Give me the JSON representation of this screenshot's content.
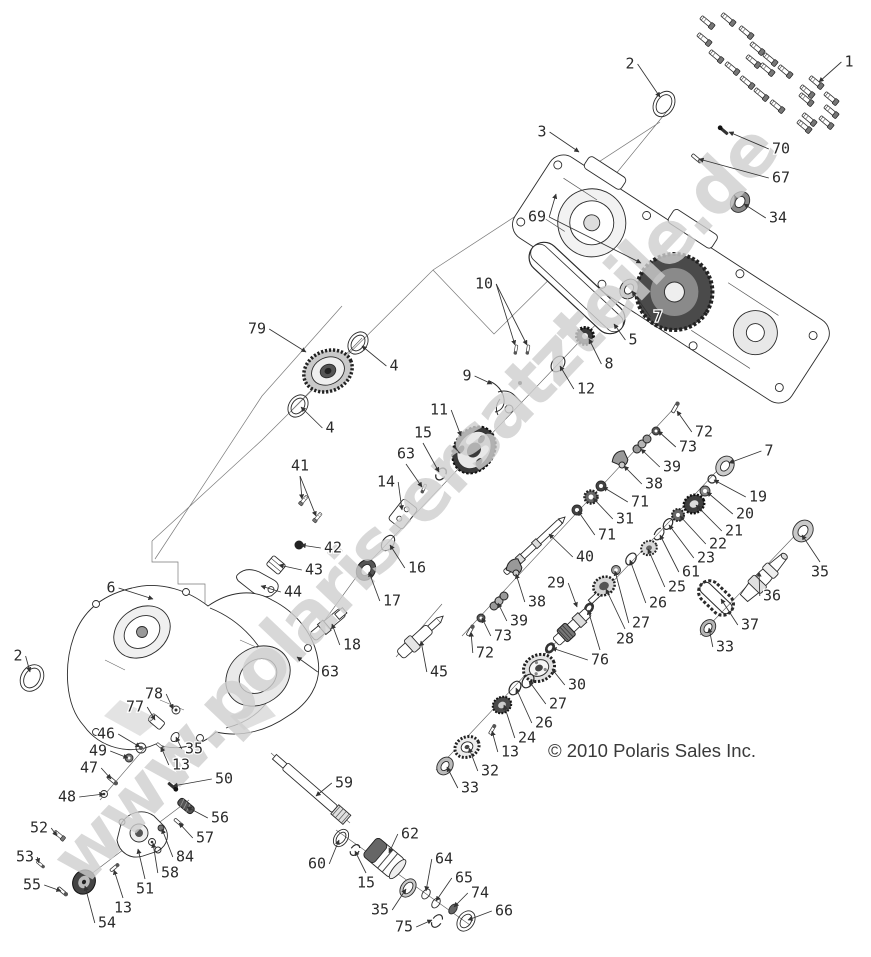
{
  "watermark": {
    "text": "www.polaris-ersatzteile.de"
  },
  "copyright": {
    "text": "© 2010 Polaris Sales Inc."
  },
  "callouts": [
    {
      "n": "1",
      "x": 849,
      "y": 62,
      "t": [
        [
          819,
          82
        ]
      ]
    },
    {
      "n": "2",
      "x": 630,
      "y": 64,
      "t": [
        [
          660,
          97
        ]
      ]
    },
    {
      "n": "3",
      "x": 542,
      "y": 132,
      "t": [
        [
          579,
          152
        ]
      ]
    },
    {
      "n": "70",
      "x": 781,
      "y": 149,
      "t": [
        [
          729,
          132
        ]
      ]
    },
    {
      "n": "67",
      "x": 781,
      "y": 178,
      "t": [
        [
          699,
          159
        ]
      ]
    },
    {
      "n": "34",
      "x": 778,
      "y": 218,
      "t": [
        [
          744,
          204
        ]
      ]
    },
    {
      "n": "69",
      "x": 537,
      "y": 217,
      "t": [
        [
          556,
          194
        ],
        [
          641,
          263
        ]
      ]
    },
    {
      "n": "10",
      "x": 484,
      "y": 284,
      "t": [
        [
          515,
          345
        ],
        [
          527,
          345
        ]
      ]
    },
    {
      "n": "7",
      "x": 658,
      "y": 317,
      "t": [
        [
          632,
          291
        ]
      ]
    },
    {
      "n": "5",
      "x": 633,
      "y": 340,
      "t": [
        [
          614,
          324
        ]
      ]
    },
    {
      "n": "8",
      "x": 609,
      "y": 364,
      "t": [
        [
          589,
          339
        ]
      ]
    },
    {
      "n": "12",
      "x": 586,
      "y": 389,
      "t": [
        [
          560,
          366
        ]
      ]
    },
    {
      "n": "9",
      "x": 467,
      "y": 376,
      "t": [
        [
          492,
          384
        ]
      ]
    },
    {
      "n": "79",
      "x": 257,
      "y": 329,
      "t": [
        [
          306,
          352
        ]
      ]
    },
    {
      "n": "4",
      "x": 394,
      "y": 366,
      "t": [
        [
          362,
          346
        ]
      ]
    },
    {
      "n": "4",
      "x": 330,
      "y": 428,
      "t": [
        [
          301,
          407
        ]
      ]
    },
    {
      "n": "11",
      "x": 439,
      "y": 410,
      "t": [
        [
          461,
          436
        ]
      ]
    },
    {
      "n": "15",
      "x": 423,
      "y": 433,
      "t": [
        [
          439,
          472
        ]
      ]
    },
    {
      "n": "63",
      "x": 406,
      "y": 454,
      "t": [
        [
          422,
          487
        ]
      ]
    },
    {
      "n": "14",
      "x": 386,
      "y": 482,
      "t": [
        [
          402,
          510
        ]
      ]
    },
    {
      "n": "41",
      "x": 300,
      "y": 466,
      "t": [
        [
          302,
          499
        ],
        [
          316,
          516
        ]
      ]
    },
    {
      "n": "42",
      "x": 333,
      "y": 548,
      "t": [
        [
          301,
          545
        ]
      ]
    },
    {
      "n": "43",
      "x": 314,
      "y": 570,
      "t": [
        [
          279,
          565
        ]
      ]
    },
    {
      "n": "44",
      "x": 293,
      "y": 592,
      "t": [
        [
          261,
          586
        ]
      ]
    },
    {
      "n": "16",
      "x": 417,
      "y": 568,
      "t": [
        [
          390,
          545
        ]
      ]
    },
    {
      "n": "17",
      "x": 392,
      "y": 601,
      "t": [
        [
          369,
          572
        ]
      ]
    },
    {
      "n": "18",
      "x": 352,
      "y": 645,
      "t": [
        [
          332,
          624
        ]
      ]
    },
    {
      "n": "63",
      "x": 330,
      "y": 672,
      "t": [
        [
          297,
          657
        ]
      ]
    },
    {
      "n": "45",
      "x": 439,
      "y": 672,
      "t": [
        [
          421,
          641
        ]
      ]
    },
    {
      "n": "6",
      "x": 111,
      "y": 588,
      "t": [
        [
          153,
          599
        ]
      ]
    },
    {
      "n": "2",
      "x": 18,
      "y": 656,
      "t": [
        [
          30,
          672
        ]
      ]
    },
    {
      "n": "72",
      "x": 704,
      "y": 432,
      "t": [
        [
          677,
          411
        ]
      ]
    },
    {
      "n": "73",
      "x": 688,
      "y": 447,
      "t": [
        [
          658,
          431
        ]
      ]
    },
    {
      "n": "39",
      "x": 672,
      "y": 467,
      "t": [
        [
          641,
          449
        ]
      ]
    },
    {
      "n": "38",
      "x": 654,
      "y": 484,
      "t": [
        [
          624,
          466
        ]
      ]
    },
    {
      "n": "71",
      "x": 640,
      "y": 502,
      "t": [
        [
          603,
          487
        ]
      ]
    },
    {
      "n": "31",
      "x": 625,
      "y": 519,
      "t": [
        [
          593,
          498
        ]
      ]
    },
    {
      "n": "71",
      "x": 607,
      "y": 535,
      "t": [
        [
          578,
          511
        ]
      ]
    },
    {
      "n": "40",
      "x": 585,
      "y": 557,
      "t": [
        [
          549,
          534
        ]
      ]
    },
    {
      "n": "7",
      "x": 769,
      "y": 451,
      "t": [
        [
          729,
          463
        ]
      ]
    },
    {
      "n": "19",
      "x": 758,
      "y": 497,
      "t": [
        [
          714,
          480
        ]
      ]
    },
    {
      "n": "20",
      "x": 745,
      "y": 514,
      "t": [
        [
          707,
          492
        ]
      ]
    },
    {
      "n": "21",
      "x": 734,
      "y": 531,
      "t": [
        [
          696,
          505
        ]
      ]
    },
    {
      "n": "22",
      "x": 718,
      "y": 544,
      "t": [
        [
          680,
          516
        ]
      ]
    },
    {
      "n": "23",
      "x": 706,
      "y": 558,
      "t": [
        [
          669,
          525
        ]
      ]
    },
    {
      "n": "61",
      "x": 691,
      "y": 572,
      "t": [
        [
          660,
          535
        ]
      ]
    },
    {
      "n": "25",
      "x": 677,
      "y": 587,
      "t": [
        [
          648,
          549
        ]
      ]
    },
    {
      "n": "26",
      "x": 658,
      "y": 603,
      "t": [
        [
          630,
          560
        ]
      ]
    },
    {
      "n": "27",
      "x": 641,
      "y": 623,
      "t": [
        [
          615,
          571
        ]
      ]
    },
    {
      "n": "28",
      "x": 625,
      "y": 639,
      "t": [
        [
          606,
          589
        ]
      ]
    },
    {
      "n": "35",
      "x": 820,
      "y": 572,
      "t": [
        [
          802,
          535
        ]
      ]
    },
    {
      "n": "36",
      "x": 772,
      "y": 596,
      "t": [
        [
          759,
          572
        ]
      ]
    },
    {
      "n": "37",
      "x": 750,
      "y": 625,
      "t": [
        [
          721,
          599
        ]
      ]
    },
    {
      "n": "33",
      "x": 725,
      "y": 647,
      "t": [
        [
          709,
          628
        ]
      ]
    },
    {
      "n": "29",
      "x": 556,
      "y": 583,
      "t": [
        [
          577,
          607
        ]
      ]
    },
    {
      "n": "38",
      "x": 537,
      "y": 602,
      "t": [
        [
          516,
          574
        ]
      ]
    },
    {
      "n": "39",
      "x": 519,
      "y": 621,
      "t": [
        [
          498,
          603
        ]
      ]
    },
    {
      "n": "73",
      "x": 503,
      "y": 636,
      "t": [
        [
          482,
          618
        ]
      ]
    },
    {
      "n": "72",
      "x": 485,
      "y": 653,
      "t": [
        [
          471,
          632
        ]
      ]
    },
    {
      "n": "76",
      "x": 600,
      "y": 660,
      "t": [
        [
          552,
          648
        ],
        [
          588,
          610
        ]
      ]
    },
    {
      "n": "30",
      "x": 577,
      "y": 685,
      "t": [
        [
          552,
          669
        ]
      ]
    },
    {
      "n": "27",
      "x": 558,
      "y": 704,
      "t": [
        [
          529,
          681
        ]
      ]
    },
    {
      "n": "26",
      "x": 544,
      "y": 723,
      "t": [
        [
          516,
          688
        ]
      ]
    },
    {
      "n": "24",
      "x": 527,
      "y": 738,
      "t": [
        [
          504,
          705
        ]
      ]
    },
    {
      "n": "13",
      "x": 510,
      "y": 752,
      "t": [
        [
          492,
          731
        ]
      ]
    },
    {
      "n": "32",
      "x": 490,
      "y": 771,
      "t": [
        [
          469,
          748
        ]
      ]
    },
    {
      "n": "33",
      "x": 470,
      "y": 788,
      "t": [
        [
          447,
          767
        ]
      ]
    },
    {
      "n": "78",
      "x": 154,
      "y": 694,
      "t": [
        [
          173,
          709
        ]
      ]
    },
    {
      "n": "77",
      "x": 135,
      "y": 707,
      "t": [
        [
          155,
          720
        ]
      ]
    },
    {
      "n": "46",
      "x": 106,
      "y": 734,
      "t": [
        [
          140,
          747
        ]
      ]
    },
    {
      "n": "49",
      "x": 98,
      "y": 751,
      "t": [
        [
          128,
          758
        ]
      ]
    },
    {
      "n": "47",
      "x": 89,
      "y": 768,
      "t": [
        [
          111,
          779
        ]
      ]
    },
    {
      "n": "48",
      "x": 67,
      "y": 797,
      "t": [
        [
          104,
          794
        ]
      ]
    },
    {
      "n": "35",
      "x": 194,
      "y": 749,
      "t": [
        [
          176,
          737
        ]
      ]
    },
    {
      "n": "13",
      "x": 181,
      "y": 765,
      "t": [
        [
          161,
          747
        ]
      ]
    },
    {
      "n": "50",
      "x": 224,
      "y": 779,
      "t": [
        [
          173,
          786
        ]
      ]
    },
    {
      "n": "56",
      "x": 220,
      "y": 818,
      "t": [
        [
          187,
          807
        ]
      ]
    },
    {
      "n": "57",
      "x": 205,
      "y": 838,
      "t": [
        [
          179,
          823
        ]
      ]
    },
    {
      "n": "84",
      "x": 185,
      "y": 857,
      "t": [
        [
          162,
          829
        ]
      ]
    },
    {
      "n": "58",
      "x": 170,
      "y": 873,
      "t": [
        [
          153,
          843
        ]
      ]
    },
    {
      "n": "51",
      "x": 145,
      "y": 889,
      "t": [
        [
          138,
          849
        ]
      ]
    },
    {
      "n": "13",
      "x": 123,
      "y": 908,
      "t": [
        [
          114,
          870
        ]
      ]
    },
    {
      "n": "54",
      "x": 107,
      "y": 923,
      "t": [
        [
          85,
          886
        ]
      ]
    },
    {
      "n": "55",
      "x": 32,
      "y": 885,
      "t": [
        [
          61,
          891
        ]
      ]
    },
    {
      "n": "53",
      "x": 25,
      "y": 857,
      "t": [
        [
          39,
          863
        ]
      ]
    },
    {
      "n": "52",
      "x": 39,
      "y": 828,
      "t": [
        [
          57,
          836
        ]
      ]
    },
    {
      "n": "59",
      "x": 344,
      "y": 783,
      "t": [
        [
          316,
          796
        ]
      ]
    },
    {
      "n": "60",
      "x": 317,
      "y": 864,
      "t": [
        [
          339,
          840
        ]
      ]
    },
    {
      "n": "15",
      "x": 366,
      "y": 883,
      "t": [
        [
          355,
          851
        ]
      ]
    },
    {
      "n": "62",
      "x": 410,
      "y": 834,
      "t": [
        [
          389,
          853
        ]
      ]
    },
    {
      "n": "35",
      "x": 380,
      "y": 910,
      "t": [
        [
          406,
          889
        ]
      ]
    },
    {
      "n": "64",
      "x": 444,
      "y": 859,
      "t": [
        [
          426,
          891
        ]
      ]
    },
    {
      "n": "65",
      "x": 464,
      "y": 878,
      "t": [
        [
          436,
          901
        ]
      ]
    },
    {
      "n": "74",
      "x": 480,
      "y": 893,
      "t": [
        [
          454,
          907
        ]
      ]
    },
    {
      "n": "75",
      "x": 404,
      "y": 927,
      "t": [
        [
          432,
          920
        ]
      ]
    },
    {
      "n": "66",
      "x": 504,
      "y": 911,
      "t": [
        [
          468,
          920
        ]
      ]
    }
  ]
}
